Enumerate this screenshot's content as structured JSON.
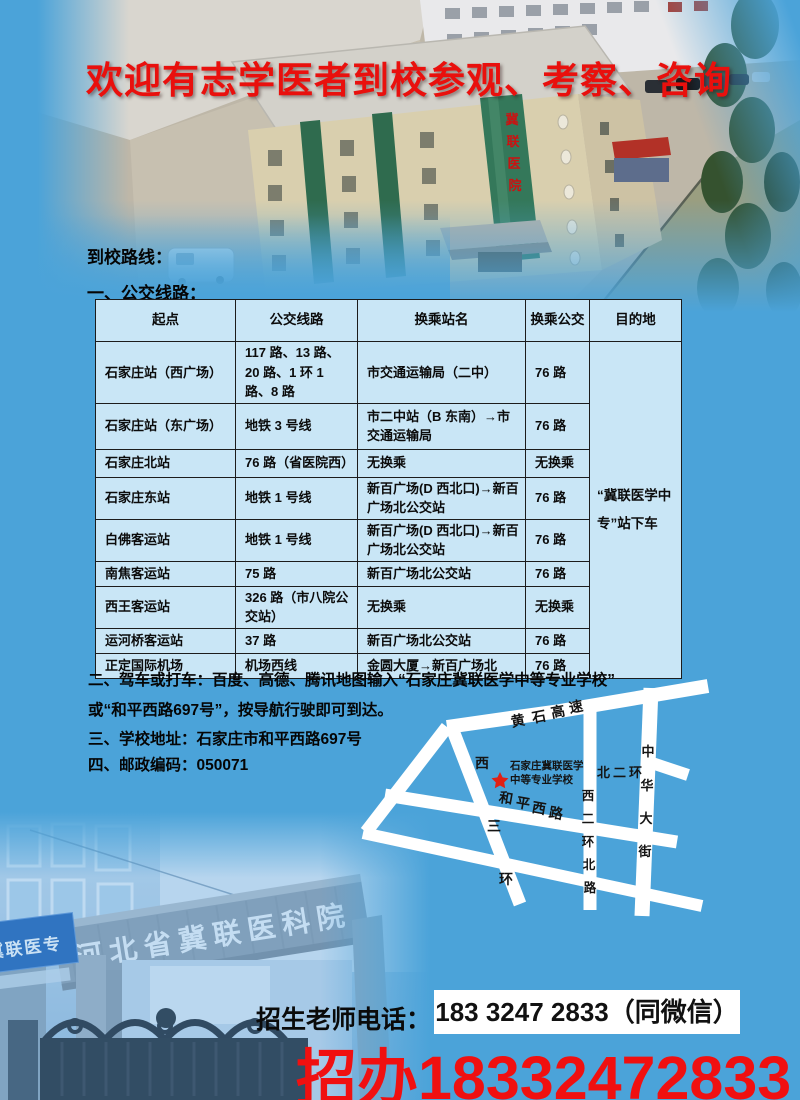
{
  "page": {
    "title_banner": "欢迎有志学医者到校参观、考察、咨询",
    "colors": {
      "background": "#4ba3d9",
      "title_red": "#e9100d",
      "hotline_red": "#f01010",
      "table_cell_bg": "#c9e6f6",
      "table_border": "#1c1c1c",
      "map_road_white": "#ffffff",
      "map_star_red": "#e02016",
      "phone_box_bg": "#ffffff"
    }
  },
  "top_photo": {
    "building_sign_chars": [
      "冀",
      "联",
      "医",
      "院"
    ]
  },
  "sections": {
    "route_heading": "到校路线：",
    "bus_heading": "一、公交线路：",
    "drive_line1": "二、驾车或打车：百度、高德、腾讯地图输入“石家庄冀联医学中等专业学校”",
    "drive_line2": "或“和平西路697号”，按导航行驶即可到达。",
    "address_line": "三、学校地址：石家庄市和平西路697号",
    "postcode_line": "四、邮政编码：050071"
  },
  "bus_table": {
    "headers": [
      "起点",
      "公交线路",
      "换乘站名",
      "换乘公交",
      "目的地"
    ],
    "destination_note": "“冀联医学中专”站下车",
    "rows": [
      {
        "start": "石家庄站（西广场）",
        "lines": "117 路、13 路、20 路、1 环 1 路、8 路",
        "transfer_station": "市交通运输局（二中）",
        "transfer_bus": "76 路"
      },
      {
        "start": "石家庄站（东广场）",
        "lines": "地铁 3 号线",
        "transfer_station": "市二中站（B 东南）→市交通运输局",
        "transfer_bus": "76 路"
      },
      {
        "start": "石家庄北站",
        "lines": "76 路（省医院西）",
        "transfer_station": "无换乘",
        "transfer_bus": "无换乘"
      },
      {
        "start": "石家庄东站",
        "lines": "地铁 1 号线",
        "transfer_station": "新百广场(D 西北口)→新百广场北公交站",
        "transfer_bus": "76 路"
      },
      {
        "start": "白佛客运站",
        "lines": "地铁 1 号线",
        "transfer_station": "新百广场(D 西北口)→新百广场北公交站",
        "transfer_bus": "76 路"
      },
      {
        "start": "南焦客运站",
        "lines": "75 路",
        "transfer_station": "新百广场北公交站",
        "transfer_bus": "76 路"
      },
      {
        "start": "西王客运站",
        "lines": "326 路（市八院公交站）",
        "transfer_station": "无换乘",
        "transfer_bus": "无换乘"
      },
      {
        "start": "运河桥客运站",
        "lines": "37 路",
        "transfer_station": "新百广场北公交站",
        "transfer_bus": "76 路"
      },
      {
        "start": "正定国际机场",
        "lines": "机场西线",
        "transfer_station": "金圆大厦→新百广场北",
        "transfer_bus": "76 路"
      }
    ]
  },
  "map": {
    "school_label_line1": "石家庄冀联医学",
    "school_label_line2": "中等专业学校",
    "roads": {
      "huangshi_expressway": [
        "黄",
        "石",
        "高",
        "速"
      ],
      "heping_west_road": [
        "和",
        "平",
        "西",
        "路"
      ],
      "west_third_ring": [
        "西",
        "三",
        "环"
      ],
      "west_second_ring_north": [
        "西",
        "二",
        "环",
        "北",
        "路"
      ],
      "north_second_ring": "北二环",
      "zhonghua_street": [
        "中",
        "华",
        "大",
        "街"
      ]
    }
  },
  "gate_photo": {
    "arch_sign": "河北省冀联医科院",
    "side_sign": "冀联医专"
  },
  "contact": {
    "label": "招生老师电话：",
    "phone_boxed": "183 3247 2833（同微信）",
    "hotline_red": "招办18332472833"
  }
}
